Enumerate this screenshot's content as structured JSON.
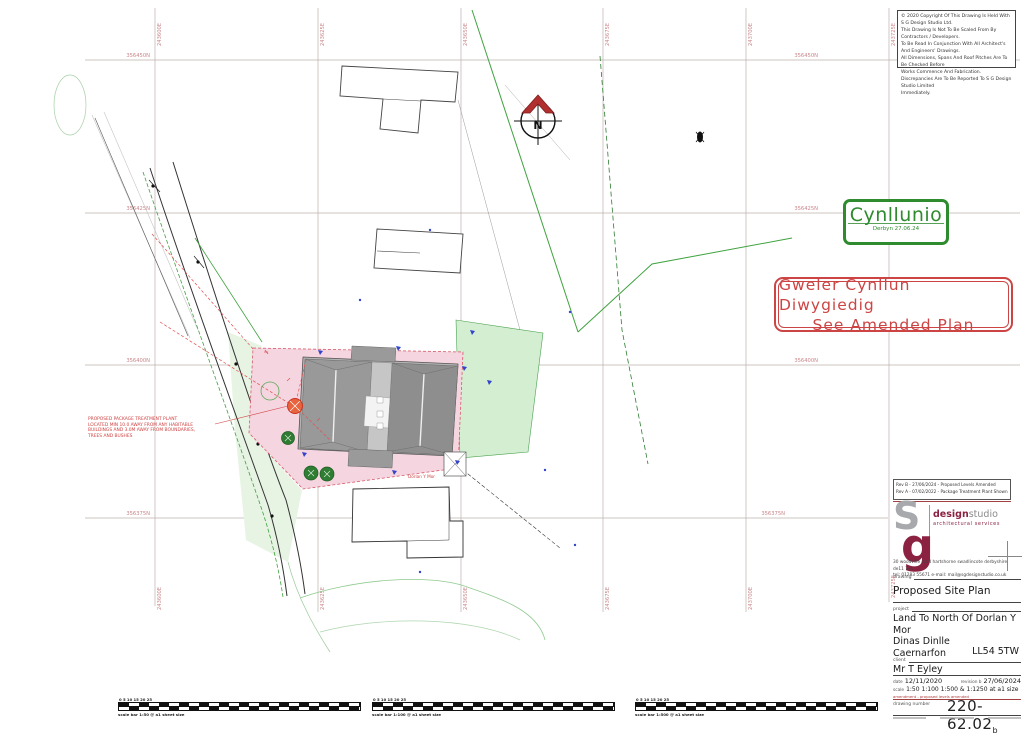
{
  "grid": {
    "northings": [
      "356450N",
      "356425N",
      "356400N",
      "356375N"
    ],
    "eastings": [
      "243600E",
      "243625E",
      "243650E",
      "243675E",
      "243700E",
      "243725E"
    ]
  },
  "copyright": {
    "lines": [
      "© 2020 Copyright Of This Drawing Is Held With S G Design Studio Ltd.",
      "This Drawing Is Not To Be Scaled From By Contractors / Developers.",
      "To Be Read In Conjunction With All Architect's And Engineers' Drawings.",
      "All Dimensions, Spans And Roof Pitches Are To Be Checked Before",
      "Works Commence And Fabrication.",
      "Discrepancies Are To Be Reported To S G Design Studio Limited",
      "Immediately."
    ]
  },
  "stamps": {
    "cynllunio": {
      "title": "Cynllunio",
      "subtitle": "Derbyn 27.06.24"
    },
    "amended": {
      "line1": "Gweler Cynllun Diwygiedig",
      "line2": "See Amended Plan"
    }
  },
  "plan": {
    "north_letter": "N",
    "dorlan_label": "Dorlan Y Mor",
    "annotation_lines": [
      "PROPOSED PACKAGE TREATMENT PLANT",
      "LOCATED MIN 10.0 AWAY FROM ANY HABITABLE",
      "BUILDINGS AND 3.0M AWAY FROM BOUNDARIES,",
      "TREES AND BUSHES"
    ]
  },
  "titleblock": {
    "revisions": [
      "Rev B - 27/06/2024 - Proposed Levels Amended",
      "Rev A - 07/02/2022 - Package Treatment Plant Shown"
    ],
    "logo": {
      "s": "S",
      "g": "g",
      "design": "design",
      "studio": "studio",
      "tagline": "architectural services"
    },
    "address_line1": "30 woodville road   hartshorne   swadlincote   derbyshire   de11 7es",
    "address_line2": "tel: 01283 55671      e-mail: mail@sgdesignstudio.co.uk",
    "drawing_label": "drawing",
    "drawing_title": "Proposed Site Plan",
    "project_label": "project",
    "project_line1": "Land To North Of Dorlan Y Mor",
    "project_line2": "Dinas Dinlle",
    "project_line3": "Caernarfon",
    "postcode": "LL54 5TW",
    "client_label": "client",
    "client": "Mr T Eyley",
    "date_label": "date",
    "date": "12/11/2020",
    "revision_label": "revision b",
    "revision_date": "27/06/2024",
    "scale_label": "scale",
    "scale": "1:50  1:100  1:500  &  1:1250  at a1 size",
    "amendment_note": "amendment - proposed levels amended",
    "number_label": "drawing number",
    "number": "220-62.02",
    "number_suffix": "b"
  },
  "scalebars": [
    {
      "ticks": "0    5    10    15    20    25",
      "label": "scale bar 1:50 @ a1 sheet size"
    },
    {
      "ticks": "0    5    10    15    20    25",
      "label": "scale bar 1:100 @ a1 sheet size"
    },
    {
      "ticks": "0    5    10    15    20    25",
      "label": "scale bar 1:500 @ a1 sheet size"
    }
  ]
}
